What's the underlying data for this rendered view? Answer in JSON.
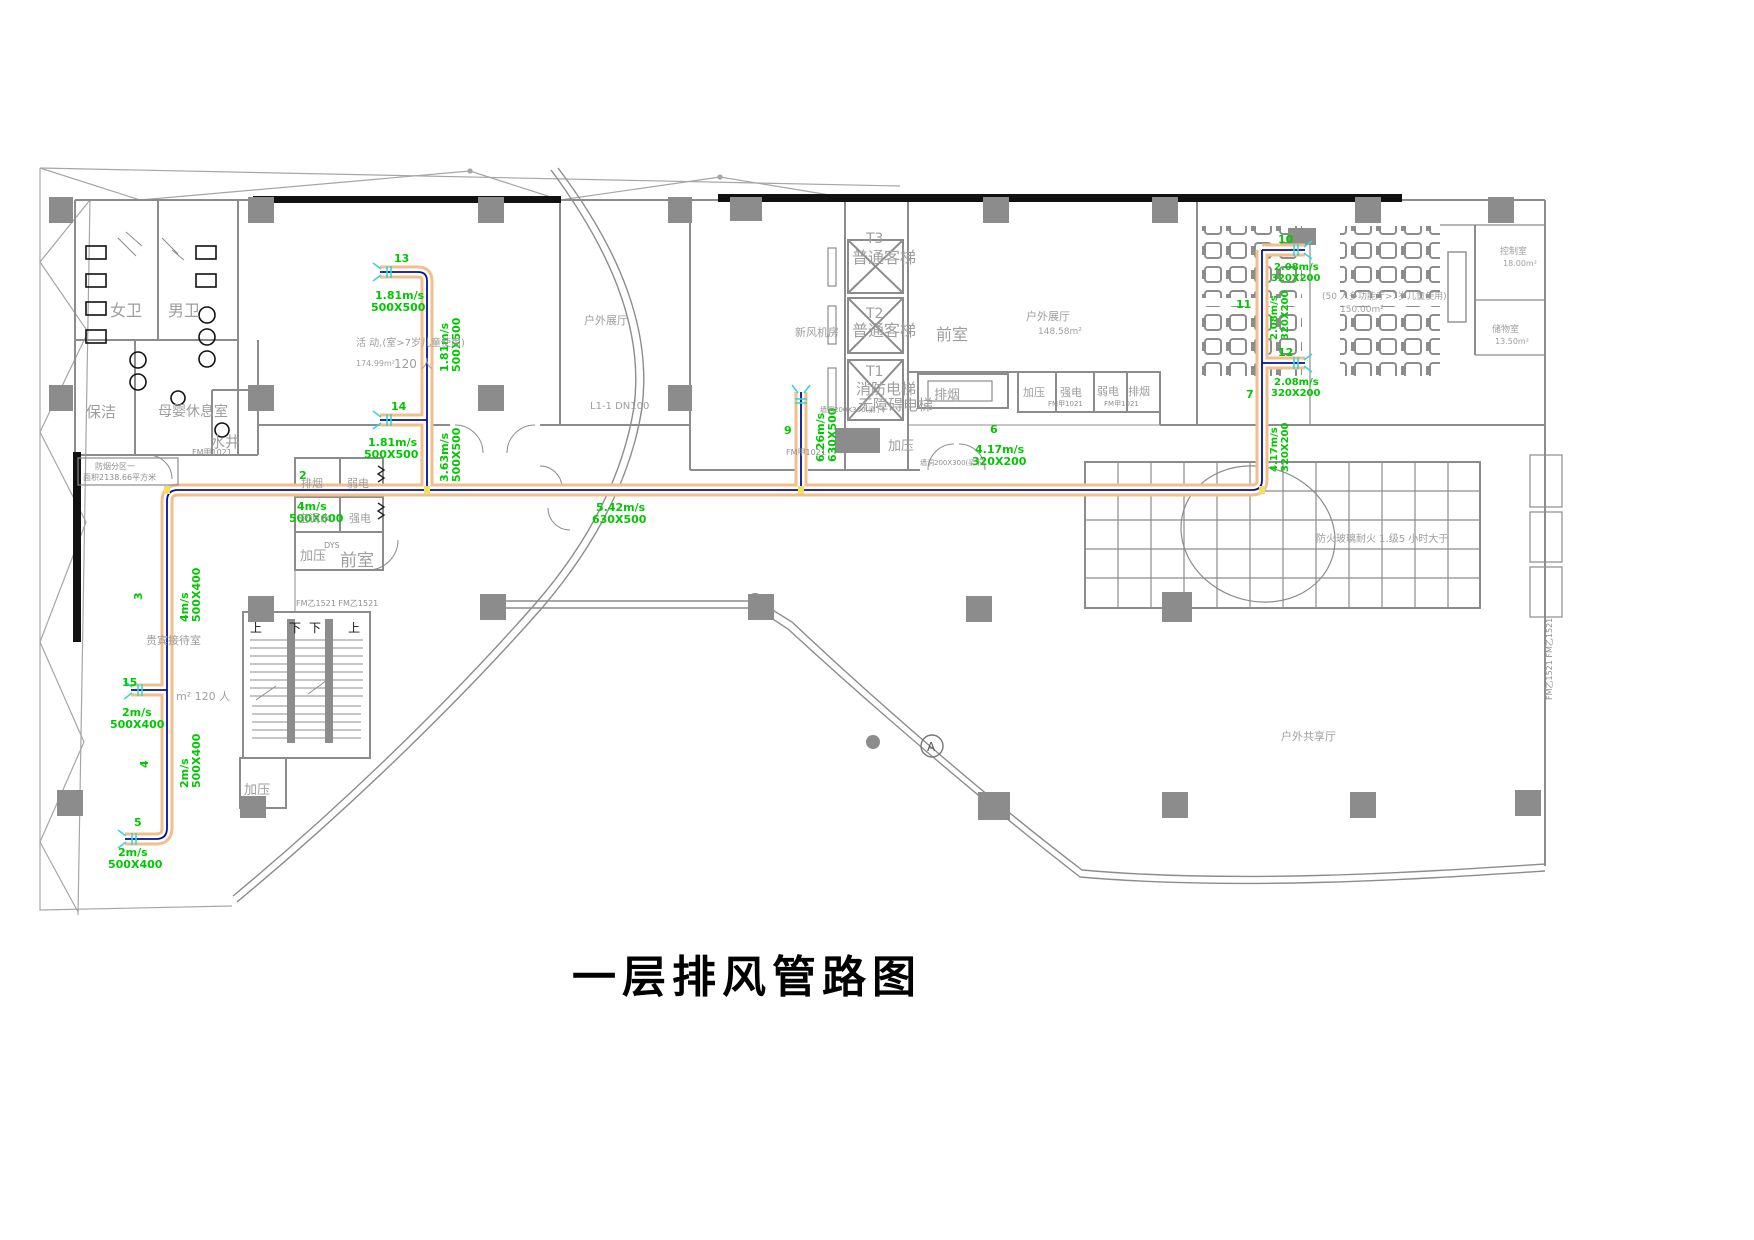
{
  "title": "一层排风管路图",
  "colors": {
    "duct_fill": "#F2BE8A",
    "duct_centerline": "#00129F",
    "label_green": "#00C800",
    "wall_gray": "#8C8C8C",
    "diffuser_cyan": "#35D6D6",
    "junction_yellow": "#F0E060"
  },
  "rooms": {
    "womens_wc": "女卫",
    "mens_wc": "男卫",
    "cleaning": "保洁",
    "nursing": "母婴休息室",
    "water_well": "水井",
    "fm_left": "FM甲1021",
    "zone_box_line1": "防烟分区一",
    "zone_box_line2": "面积2138.66平方米",
    "activity_name": "活 动,(室>7岁儿童使用)",
    "activity_area": "174.99m²",
    "activity_cap": "120 人",
    "outdoor_hall_left": "户外展厅",
    "fresh_air_room": "新风机房",
    "t3": "T3",
    "t3_type": "普通客梯",
    "t2": "T2",
    "t2_type": "普通客梯",
    "front_room_mid": "前室",
    "t1": "T1",
    "t1_line1": "消防电梯",
    "t1_line2": "无障碍电梯",
    "t1_pressure": "加压",
    "l1_pipe": "L1-1 DN100",
    "wall_hole_1": "墙洞200X300(梁下)",
    "wall_hole_2": "墙洞200X300(梁下)",
    "smoke_shaft": "排烟",
    "blk_jiaya": "加压",
    "blk_qiangdian": "强电",
    "blk_fm1": "FM甲1021",
    "blk_ruodian": "弱电",
    "blk_paiyan": "排烟",
    "blk_fm2": "FM甲1021",
    "outdoor_hall_right": "户外展厅",
    "outdoor_hall_right_area": "148.58m²",
    "multi_hall_name": "(50 人多功能厅>7岁儿童使用)",
    "multi_hall_area": "150.00m²",
    "control_room": "控制室",
    "control_room_area": "18.00m²",
    "storage_room": "储物室",
    "storage_room_area": "13.50m²",
    "vip_room": "贵宾接待室",
    "vip_cap": "m² 120 人",
    "lblk_paiyan": "排烟",
    "lblk_ruodian": "弱电",
    "lblk_ktshui": "空调水",
    "lblk_qiangdian": "强电",
    "lblk_jiaya": "加压",
    "lblk_qianshi": "前室",
    "lblk_dys": "DYS",
    "lblk_fm": "FM乙1521 FM乙1521",
    "stair_up1": "上",
    "stair_dn1": "下",
    "stair_dn2": "下",
    "stair_up2": "上",
    "bottom_jiaya": "加压",
    "fire_glass": "防火玻璃耐火 1.级5 小时大于",
    "shared_hall": "户外共享厅",
    "right_fm_vertical": "FM乙1521 FM乙1521",
    "datum_a": "A"
  },
  "ducts": {
    "n2": "2",
    "v2": "4m/s",
    "s2": "500X600",
    "n3": "3",
    "v3": "4m/s",
    "s3": "500X400",
    "n4": "4",
    "v4": "2m/s",
    "s4": "500X400",
    "n5": "5",
    "v5": "2m/s",
    "s5": "500X400",
    "n15": "15",
    "v15": "2m/s",
    "s15": "500X400",
    "n13": "13",
    "v13": "1.81m/s",
    "s13": "500X500",
    "n14": "14",
    "v14": "1.81m/s",
    "s14": "500X500",
    "act_mid_v": "1.81m/s",
    "act_mid_s": "500X500",
    "act_low_v": "3.63m/s",
    "act_low_s": "500X500",
    "main_v": "5.42m/s",
    "main_s": "630X500",
    "riser_n": "9",
    "riser_v": "6.26m/s",
    "riser_s": "630X500",
    "riser_fm": "FM甲1021",
    "n6": "6",
    "v6": "4.17m/s",
    "s6": "320X200",
    "n7": "7",
    "n10": "10",
    "v10": "2.08m/s",
    "s10": "320X200",
    "n11": "11",
    "r_mid_v": "2.08m/s",
    "r_mid_s": "320X200",
    "n12": "12",
    "v12": "2.08m/s",
    "s12": "320X200",
    "r_low_v": "4.17m/s",
    "r_low_s": "320X200"
  }
}
